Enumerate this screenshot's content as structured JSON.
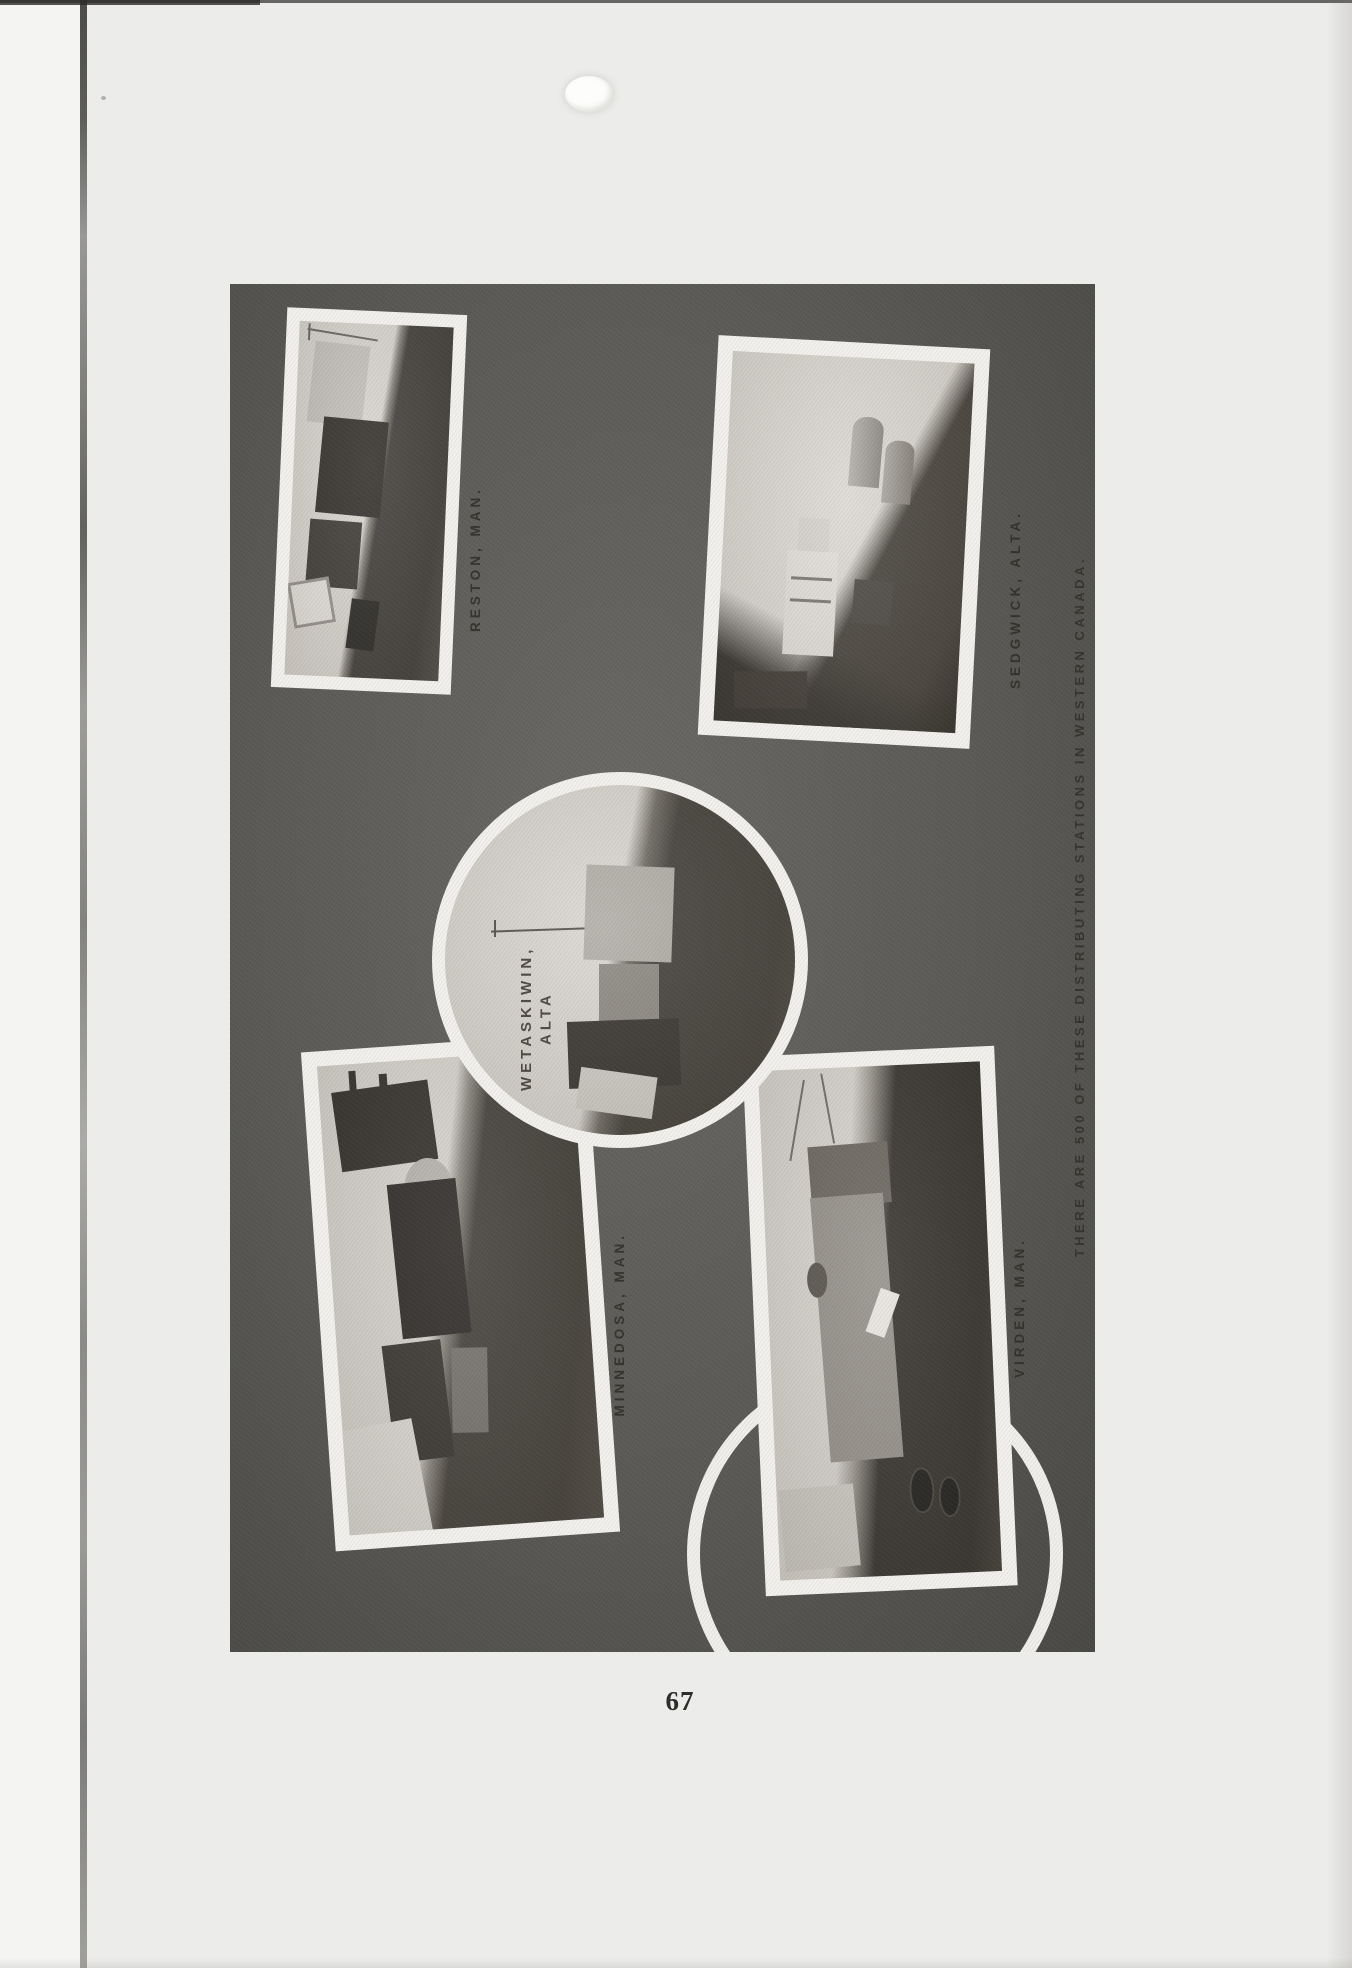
{
  "page": {
    "number": "67"
  },
  "collage": {
    "caption": "THERE ARE 500 OF THESE DISTRIBUTING STATIONS IN WESTERN CANADA.",
    "photos": [
      {
        "id": "reston",
        "label": "RESTON, MAN."
      },
      {
        "id": "sedgwick",
        "label": "SEDGWICK, ALTA."
      },
      {
        "id": "minnedosa",
        "label": "MINNEDOSA, MAN."
      },
      {
        "id": "virden",
        "label": "VIRDEN, MAN."
      },
      {
        "id": "wetaskiwin",
        "label_line1": "WETASKIWIN,",
        "label_line2": "ALTA"
      }
    ]
  }
}
